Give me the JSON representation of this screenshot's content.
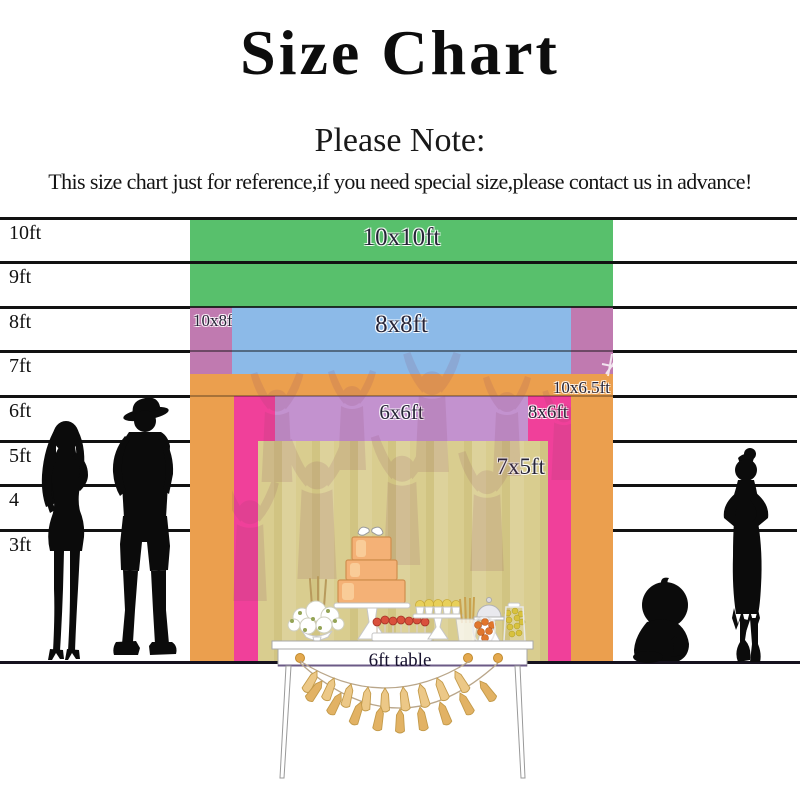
{
  "header": {
    "title": "Size Chart",
    "note_heading": "Please Note:",
    "notice": "This size chart just for reference,if you need special size,please contact us in advance!"
  },
  "ruler": {
    "unit": "ft",
    "line_labels": [
      "10ft",
      "9ft",
      "8ft",
      "7ft",
      "6ft",
      "5ft",
      "4",
      "3ft"
    ]
  },
  "sizes": [
    {
      "label": "10x10ft",
      "width_ft": 10,
      "height_ft": 10,
      "color": "#58c06c"
    },
    {
      "label": "10x8ft",
      "width_ft": 10,
      "height_ft": 8,
      "color": "#c07ab0"
    },
    {
      "label": "8x8ft",
      "width_ft": 8,
      "height_ft": 8,
      "color": "#8cbae8"
    },
    {
      "label": "10x6.5ft",
      "width_ft": 10,
      "height_ft": 6.5,
      "color": "#eb9f4e"
    },
    {
      "label": "8x6ft",
      "width_ft": 8,
      "height_ft": 6,
      "color": "#f0409a"
    },
    {
      "label": "6x6ft",
      "width_ft": 6,
      "height_ft": 6,
      "color": "#c392cf"
    },
    {
      "label": "7x5ft",
      "width_ft": 7,
      "height_ft": 5,
      "color": "#d9cd8f"
    }
  ],
  "table": {
    "label": "6ft table"
  },
  "figures": {
    "left_woman": "adult-woman-silhouette",
    "left_man": "man-with-hat-silhouette",
    "right_girl": "girl-hands-on-hips-silhouette",
    "baby": "sitting-baby-silhouette"
  }
}
